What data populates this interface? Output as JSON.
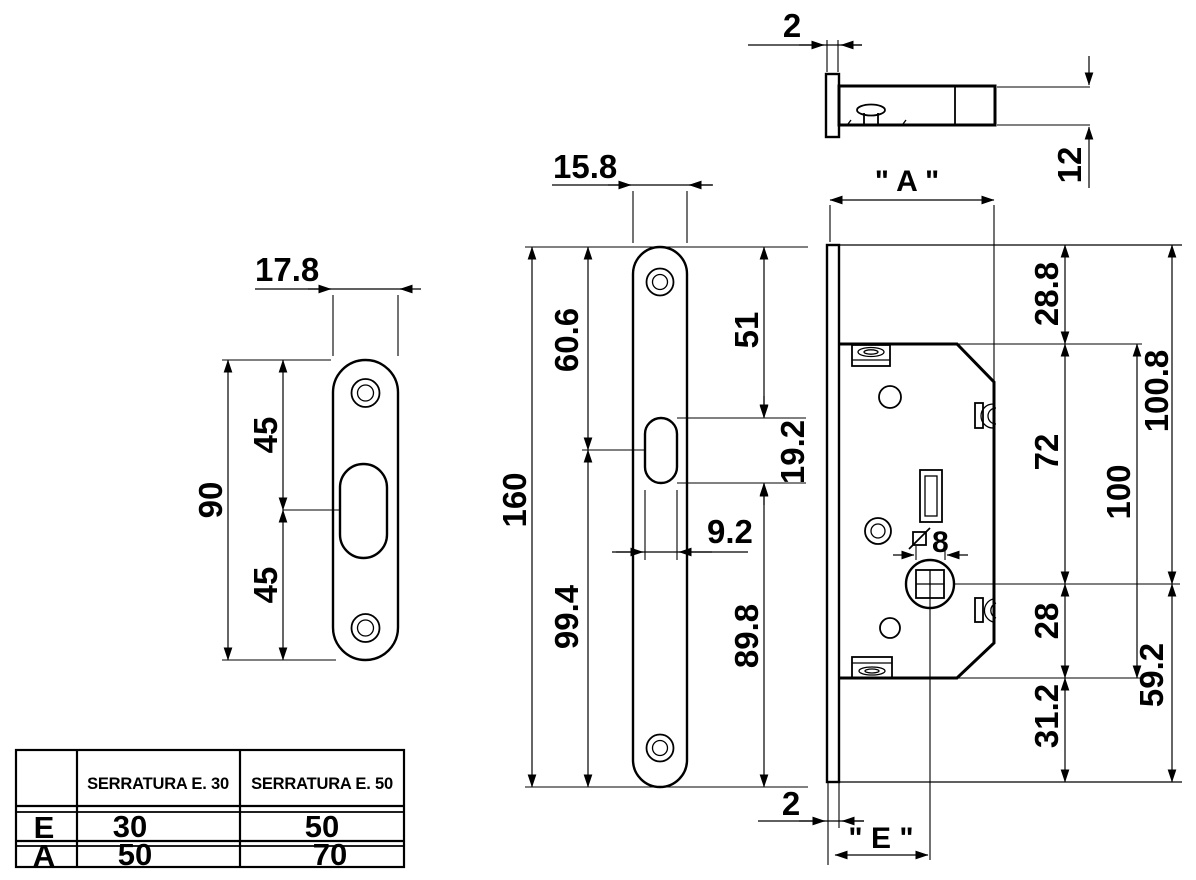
{
  "drawing_labels": {
    "back_plate": {
      "width": "17.8",
      "total_height": "90",
      "upper_half": "45",
      "lower_half": "45"
    },
    "faceplate": {
      "width": "15.8",
      "total_height": "160",
      "top_to_slot_center": "60.6",
      "slot_center_to_bottom": "99.4",
      "top_to_slot_top": "51",
      "slot_height": "19.2",
      "slot_width": "9.2",
      "slot_bottom_to_bottom": "89.8"
    },
    "side_view": {
      "plate_thickness": "2",
      "case_thickness": "12"
    },
    "main_view": {
      "case_width": "\" A \"",
      "backset": "\" E \"",
      "plate_thickness_bottom": "2",
      "plate_top_to_case_top": "28.8",
      "case_top_to_spindle": "72",
      "spindle_to_case_bottom": "28",
      "case_bottom_to_plate_bottom": "31.2",
      "case_height": "100",
      "plate_top_to_spindle": "100.8",
      "spindle_to_plate_bottom": "59.2",
      "spindle_square": "8"
    }
  },
  "table": {
    "col_headers": [
      "SERRATURA E. 30",
      "SERRATURA E. 50"
    ],
    "rows": [
      {
        "label": "E",
        "values": [
          "30",
          "50"
        ]
      },
      {
        "label": "A",
        "values": [
          "50",
          "70"
        ]
      }
    ]
  }
}
